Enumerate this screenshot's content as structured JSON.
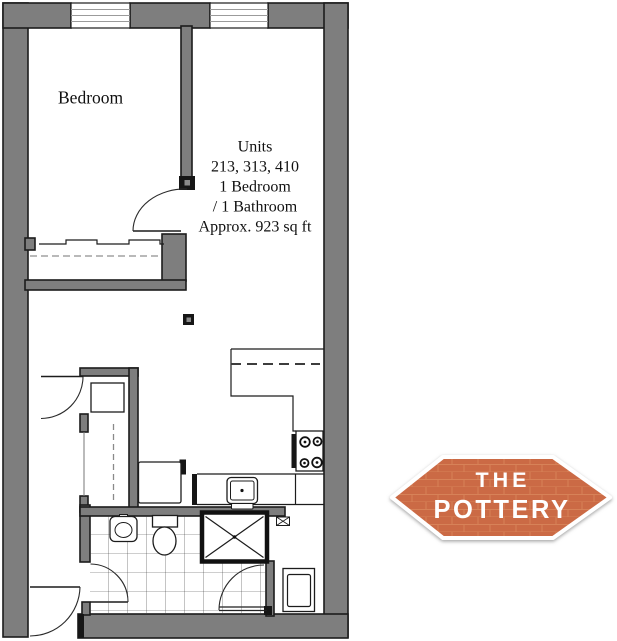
{
  "floor_plan": {
    "bedroom_label": "Bedroom",
    "unit_info": {
      "line1": "Units",
      "line2": "213, 313, 410",
      "line3": "1 Bedroom",
      "line4": "/ 1 Bathroom",
      "line5": "Approx. 923 sq ft"
    }
  },
  "logo": {
    "line1": "THE",
    "line2": "POTTERY"
  },
  "colors": {
    "wall_fill": "#7e7e7e",
    "wall_outline": "#1c1c1c",
    "window_line": "#9b9b9b",
    "tile_line": "#3a3a3a",
    "logo_fill": "#cb6a45",
    "logo_brick_line": "#da8960",
    "logo_border": "#ffffff",
    "logo_text": "#ffffff"
  }
}
